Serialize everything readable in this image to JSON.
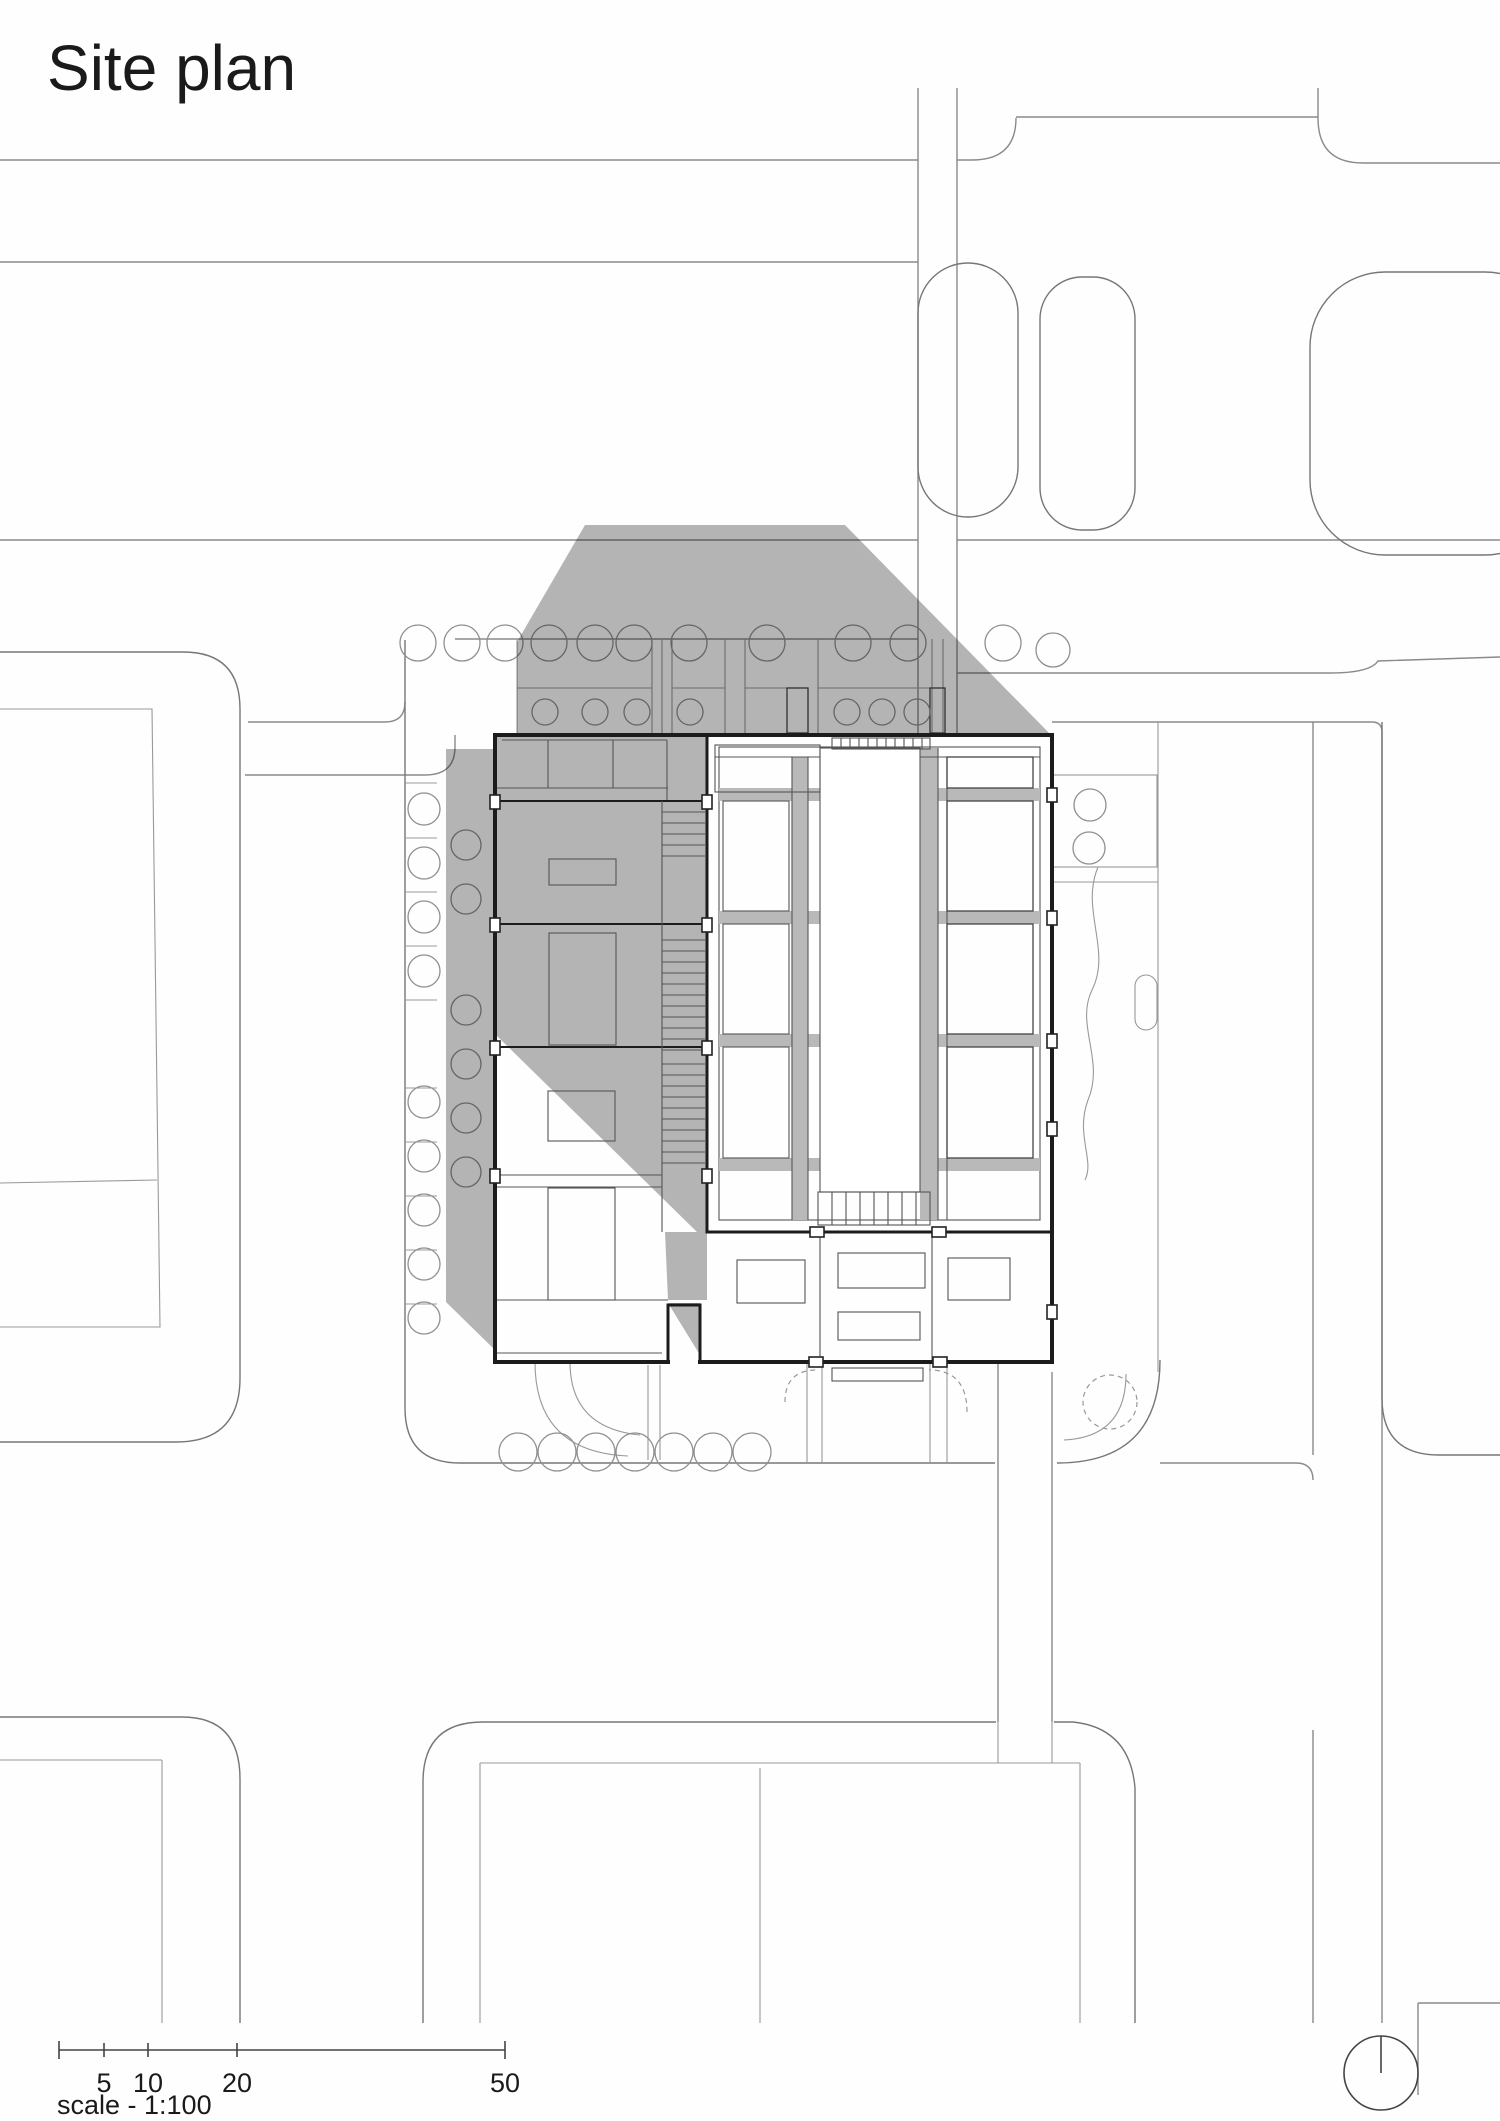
{
  "title": "Site plan",
  "scale_bar": {
    "labels": [
      "5",
      "10",
      "20",
      "50"
    ],
    "caption": "scale - 1:100"
  },
  "icons": {
    "north_arrow": "north-indicator-circle"
  },
  "colors": {
    "shadow_gray": "#b5b5b5",
    "wall_black": "#1c1c1c",
    "road_gray": "#8a8a8a",
    "interior_gray": "#555555",
    "floor_band_gray": "#b9b9b9",
    "text_color": "#1a1a1a"
  }
}
